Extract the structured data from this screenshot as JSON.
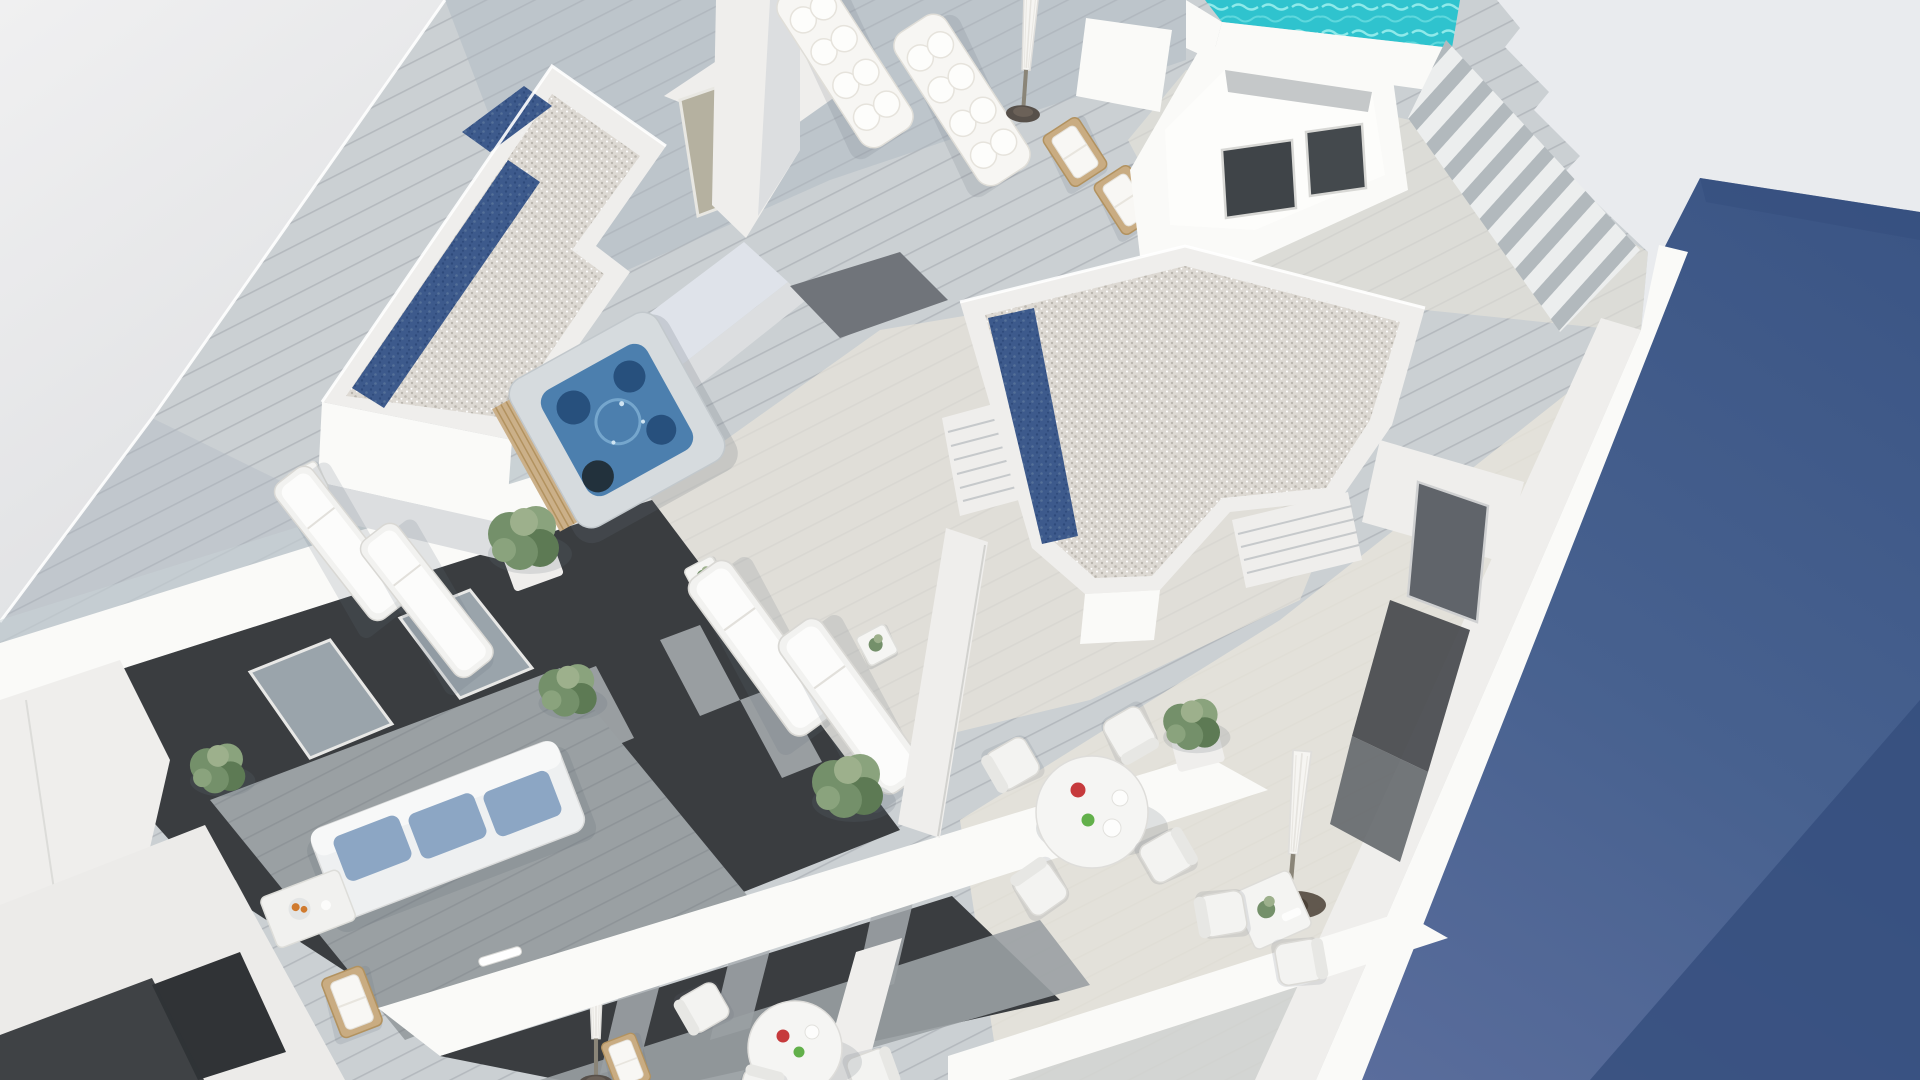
{
  "scene": {
    "type": "3d-architectural-render",
    "description": "Aerial 3D rendering of a modern white apartment building: rooftop solarium terraces with wood decking, gravel-covered roof volumes with dark blue skylight strips, a turquoise plunge pool with stairs, a square jacuzzi, white sun loungers, wooden folding deck chairs, closed parasols, round and square dining sets, green planters, and lower-floor balconies with a blue-cushioned sofa against a dark facade; a slate-blue neighbouring wall fills the right side.",
    "objects": [
      "white-roof-plane",
      "gravel-roof-L",
      "gravel-roof-T",
      "skylight-strip",
      "pool",
      "pool-stairs",
      "stair-bulkhead-lightwell",
      "jacuzzi",
      "plush-lounger",
      "sun-lounger",
      "wood-deck-chair",
      "closed-parasol",
      "round-dining-table",
      "square-bistro-table",
      "terrace-chair",
      "side-table",
      "planter-bush",
      "divider-wall",
      "parapet",
      "louver-roof",
      "roof-vent",
      "gray-door",
      "stair-nook",
      "balcony-sofa",
      "coffee-table-with-fruit",
      "glass-balustrade",
      "dark-facade",
      "curtains",
      "balcony-window",
      "blue-neighbour-wall"
    ]
  },
  "colors": {
    "sky": "#e9ebee",
    "blueA": "#3c5687",
    "blueB": "#5a6d9c",
    "blueDark": "#344e7d",
    "deck": "#cbd0d3",
    "deckSun": "#e8e4da",
    "deckShad": "#aeb8c2",
    "wallBright": "#fafaf8",
    "wallMid": "#efeeec",
    "wallShade": "#dcdee0",
    "wallBlue": "#dfe3ea",
    "gravel": "#ddd9d3",
    "gravelDot": "#bab6ae",
    "navy": "#3d5a8c",
    "navyDot": "#2e4a7b",
    "pool": "#2fc3ce",
    "poolLt": "#8feaea",
    "jacuzzi": "#4c7fae",
    "jacuzziDk": "#27507d",
    "charcoal": "#3a3d40",
    "charcoal2": "#303336",
    "glass": "#9aa4ab",
    "glassLt": "#c9d3d8",
    "curtain": "#aaafb3",
    "floorGray": "#9aa0a3",
    "doorGray": "#60646a",
    "green": "#74906a",
    "greenDk": "#5d7a54",
    "greenLt": "#9db08c",
    "woodTan": "#c9ac82",
    "cushion": "#8ca6c4",
    "red": "#c63a3c",
    "lime": "#62b04a",
    "orange": "#d07b2f",
    "umbBase": "#57504a",
    "beigeGlass": "#b5b1a0"
  }
}
